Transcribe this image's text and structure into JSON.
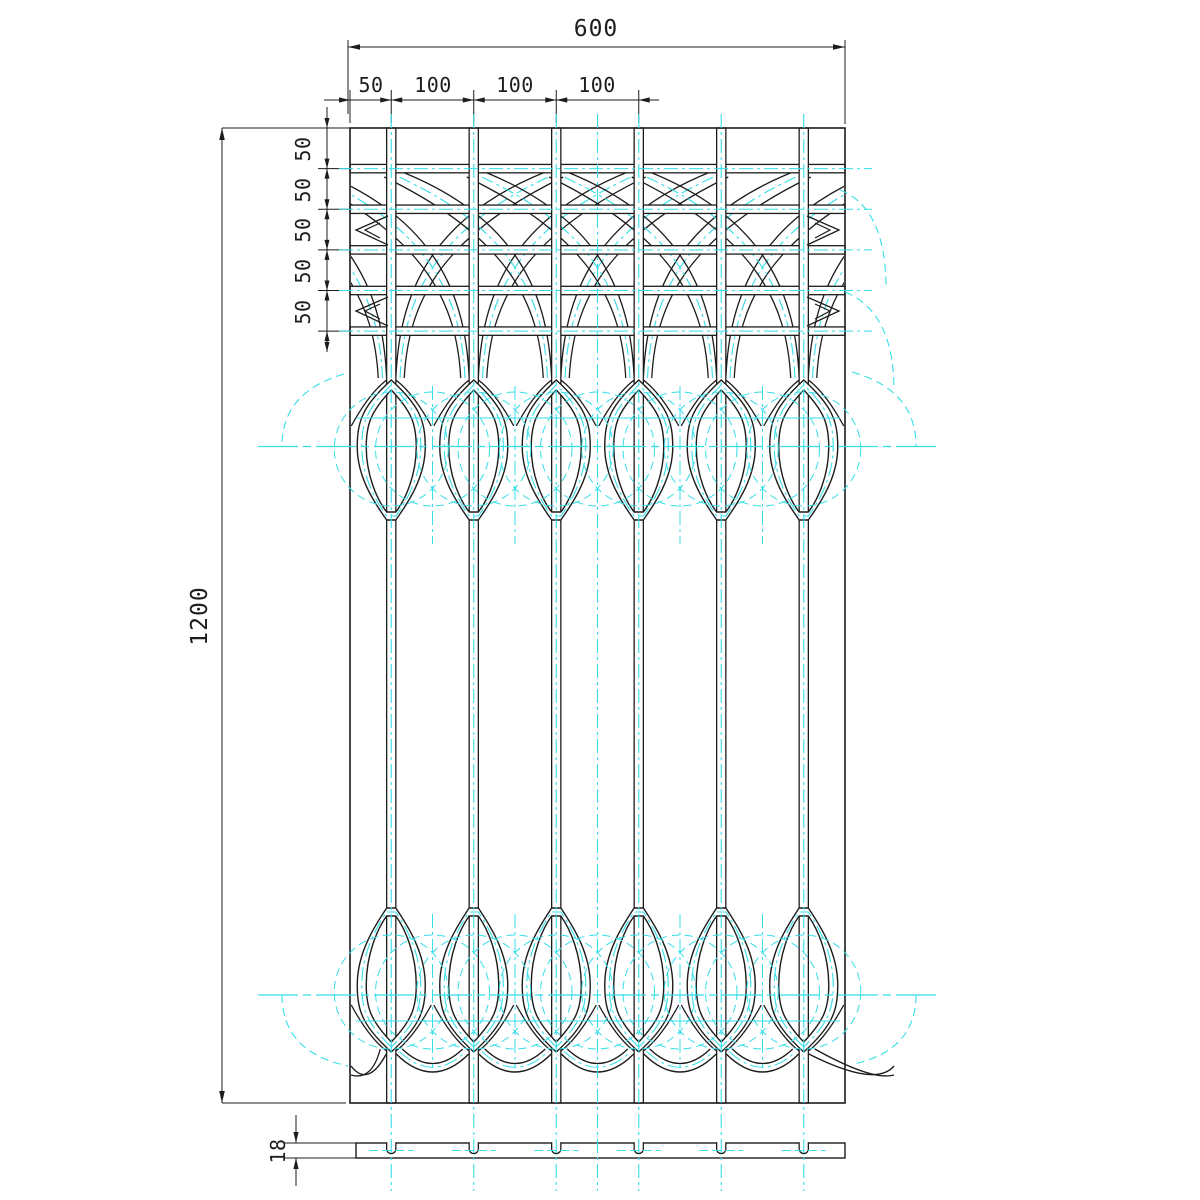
{
  "drawing": {
    "type": "cad-technical-drawing",
    "subject": "decorative-grille-panel",
    "views": 2,
    "dimensions": {
      "overall_width": "600",
      "overall_height": "1200",
      "thickness": "18",
      "top_chain": [
        "50",
        "100",
        "100",
        "100"
      ],
      "left_chain": [
        "50",
        "50",
        "50",
        "50",
        "50"
      ]
    },
    "structure": {
      "bar_count": 6,
      "rail_count": 5,
      "bar_first_offset_units": 50,
      "bar_spacing_units": 100,
      "rail_spacing_units": 50
    },
    "colors": {
      "line": "#1c1c1c",
      "construction": "#35dee8",
      "background": "#ffffff",
      "text": "#1d1d1d"
    }
  }
}
